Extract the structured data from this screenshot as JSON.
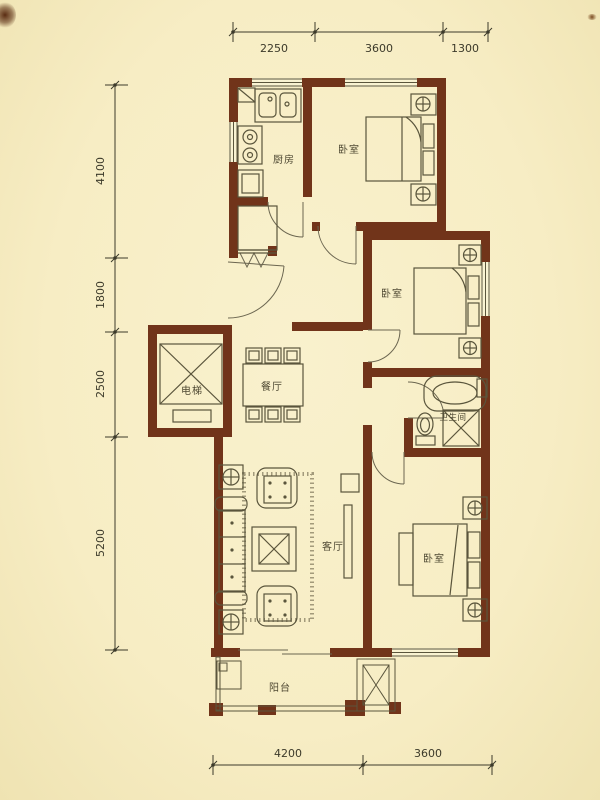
{
  "plan": {
    "title": "apartment-floor-plan",
    "rooms": {
      "kitchen": {
        "label": "厨房"
      },
      "bedroom_top": {
        "label": "卧室"
      },
      "bedroom_middle": {
        "label": "卧室"
      },
      "bedroom_bottom": {
        "label": "卧室"
      },
      "dining": {
        "label": "餐厅"
      },
      "living": {
        "label": "客厅"
      },
      "bathroom": {
        "label": "卫生间"
      },
      "elevator": {
        "label": "电梯"
      },
      "balcony": {
        "label": "阳台"
      }
    },
    "dimensions": {
      "top": [
        "2250",
        "3600",
        "1300"
      ],
      "left": [
        "4100",
        "1800",
        "2500",
        "5200"
      ],
      "bottom": [
        "4200",
        "3600"
      ]
    },
    "colors": {
      "background": "#f7edc4",
      "wall": "#71341a",
      "furniture_line": "#5a553c",
      "dimension": "#3c3a2a",
      "label": "#4f4933"
    }
  }
}
